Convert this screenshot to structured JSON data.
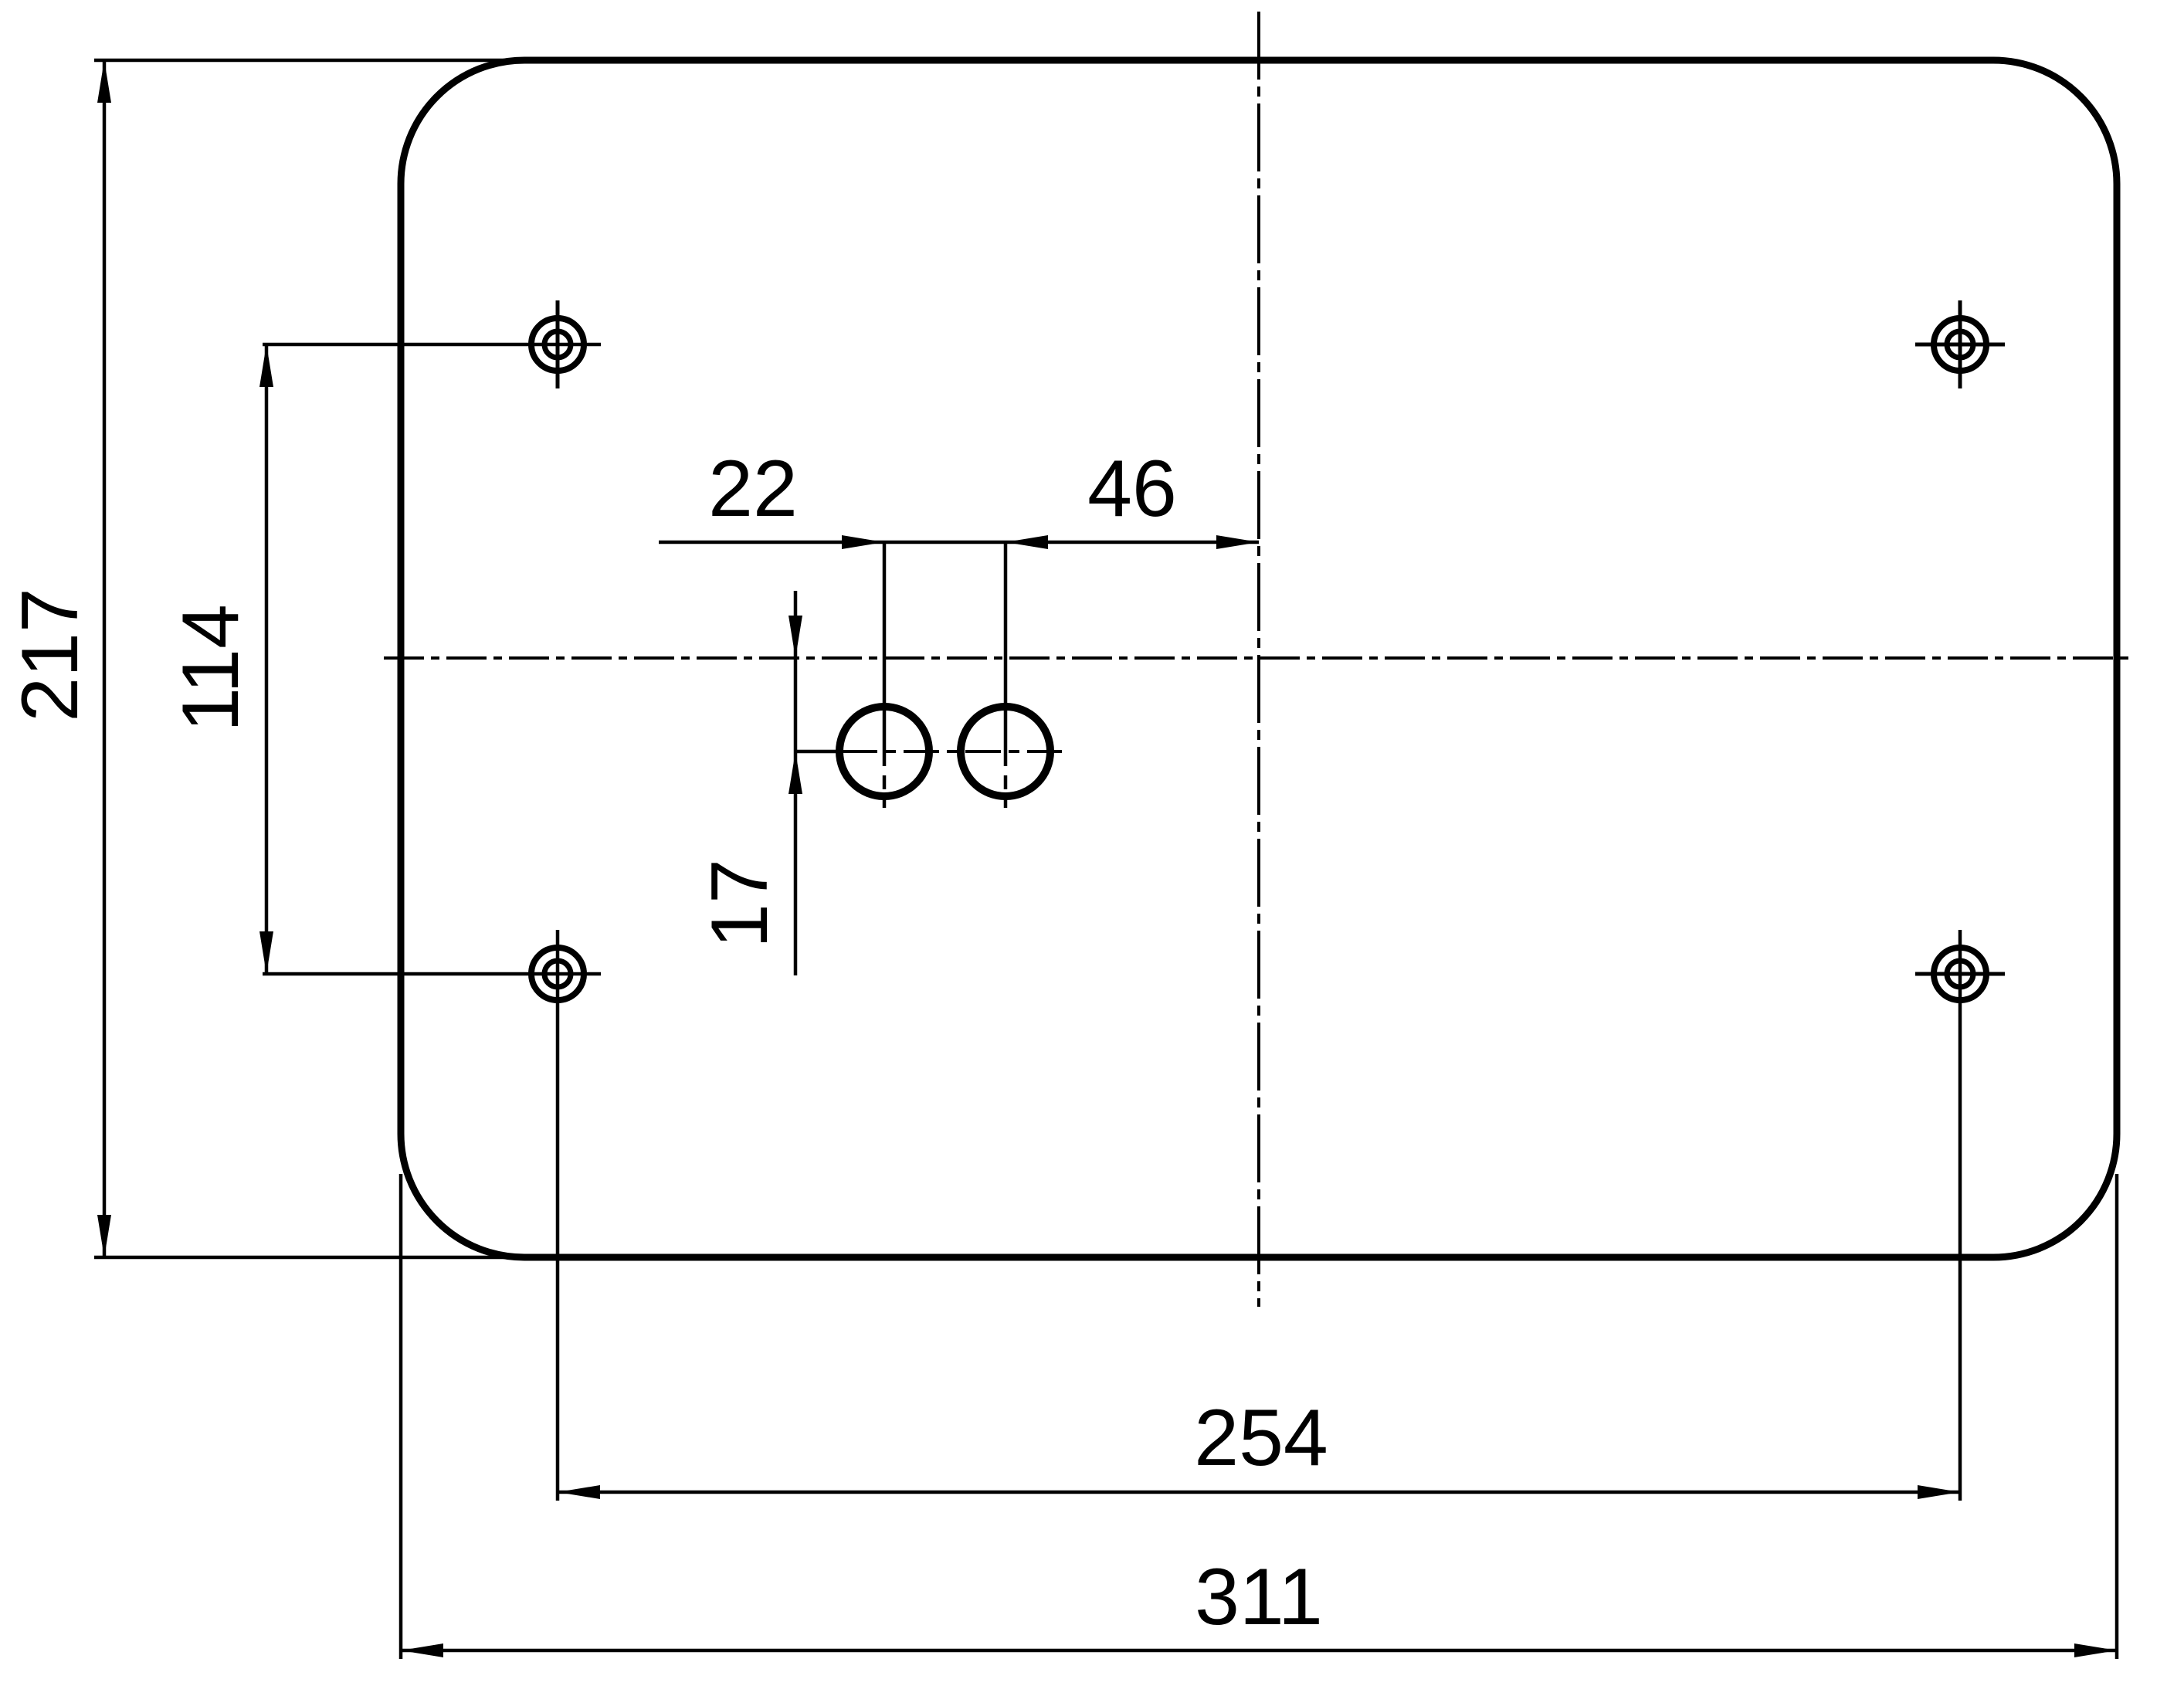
{
  "drawing": {
    "background": "#ffffff",
    "line_color": "#000000",
    "dimensions": {
      "overall_height": {
        "label": "217",
        "value": 217,
        "orientation": "vertical"
      },
      "left_hole_spacing": {
        "label": "114",
        "value": 114,
        "orientation": "vertical"
      },
      "slot_hole_spacing": {
        "label": "22",
        "value": 22,
        "orientation": "horizontal"
      },
      "slot_to_centerline": {
        "label": "46",
        "value": 46,
        "orientation": "horizontal"
      },
      "slot_below_centerline": {
        "label": "17",
        "value": 17,
        "orientation": "vertical"
      },
      "bottom_hole_spacing": {
        "label": "254",
        "value": 254,
        "orientation": "horizontal"
      },
      "overall_width": {
        "label": "311",
        "value": 311,
        "orientation": "horizontal"
      }
    }
  }
}
